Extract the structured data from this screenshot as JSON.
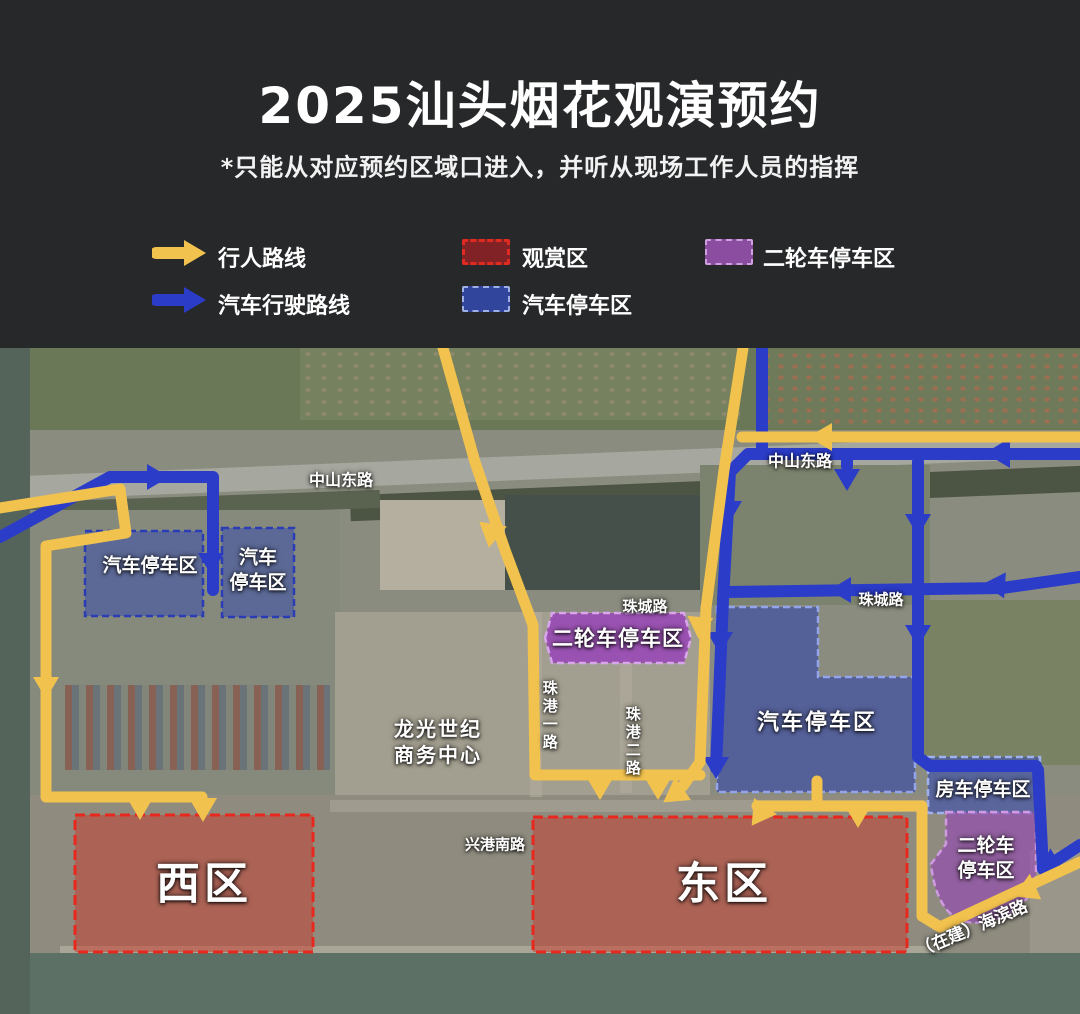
{
  "header": {
    "title": "2025汕头烟花观演预约",
    "subtitle": "*只能从对应预约区域口进入，并听从现场工作人员的指挥"
  },
  "legend": {
    "pedestrian_route": "行人路线",
    "car_route": "汽车行驶路线",
    "viewing_zone": "观赏区",
    "car_parking": "汽车停车区",
    "two_wheeler_parking": "二轮车停车区"
  },
  "map": {
    "roads": {
      "zhongshan_east": "中山东路",
      "zhucheng": "珠城路",
      "zhugang_1": "珠港一路",
      "zhugang_2": "珠港二路",
      "xinggang_south": "兴港南路",
      "haibin_under_construction": "（在建）海滨路"
    },
    "zones": {
      "car_parking": "汽车停车区",
      "car_parking_line1": "汽车",
      "car_parking_line2": "停车区",
      "two_wheeler_parking": "二轮车停车区",
      "two_wheeler_line1": "二轮车",
      "two_wheeler_line2": "停车区",
      "rv_parking": "房车停车区",
      "west_zone": "西区",
      "east_zone": "东区",
      "business_center_line1": "龙光世纪",
      "business_center_line2": "商务中心"
    },
    "colors": {
      "pedestrian_route": "#f2c24e",
      "car_route": "#2b3cc9",
      "viewing_zone_border": "#e8281e",
      "car_parking_fill": "#3a4eac",
      "two_wheeler_fill": "#973eba"
    }
  }
}
